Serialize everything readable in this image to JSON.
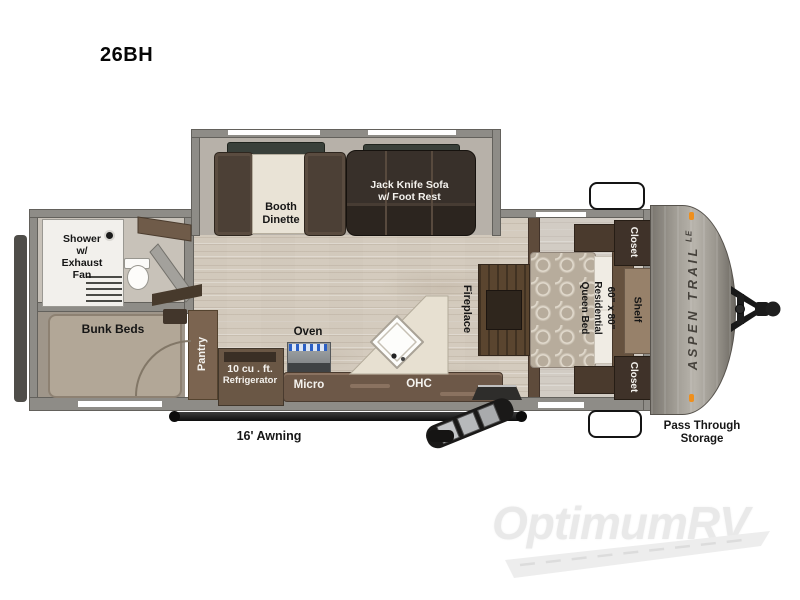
{
  "title": "26BH",
  "watermark": "OptimumRV",
  "plan": {
    "slide": {
      "booth_line1": "Booth",
      "booth_line2": "Dinette",
      "sofa_line1": "Jack Knife Sofa",
      "sofa_line2": "w/ Foot Rest"
    },
    "bath": {
      "shower_line1": "Shower",
      "shower_line2": "w/",
      "shower_line3": "Exhaust",
      "shower_line4": "Fan"
    },
    "bunk": {
      "label": "Bunk Beds"
    },
    "kitchen": {
      "pantry": "Pantry",
      "fridge_line1": "10 cu . ft.",
      "fridge_line2": "Refrigerator",
      "oven": "Oven",
      "micro": "Micro",
      "ohc": "OHC"
    },
    "living": {
      "fireplace": "Fireplace"
    },
    "bedroom": {
      "bed_line1": "60\" x 80\"",
      "bed_line2": "Residential",
      "bed_line3": "Queen Bed",
      "shelf": "Shelf",
      "closet_top": "Closet",
      "closet_bottom": "Closet"
    },
    "exterior": {
      "awning": "16' Awning",
      "pass_line1": "Pass Through",
      "pass_line2": "Storage",
      "brand": "ASPEN TRAIL",
      "brand_suffix": "LE"
    }
  },
  "colors": {
    "wall_gray": "#8e8c87",
    "wood_floor": "#d8d0c3",
    "slide_floor": "#b7b1a9",
    "cabinet_brown": "#6d584a",
    "sofa_dark": "#322a24",
    "marker_orange": "#ef8f1c"
  }
}
